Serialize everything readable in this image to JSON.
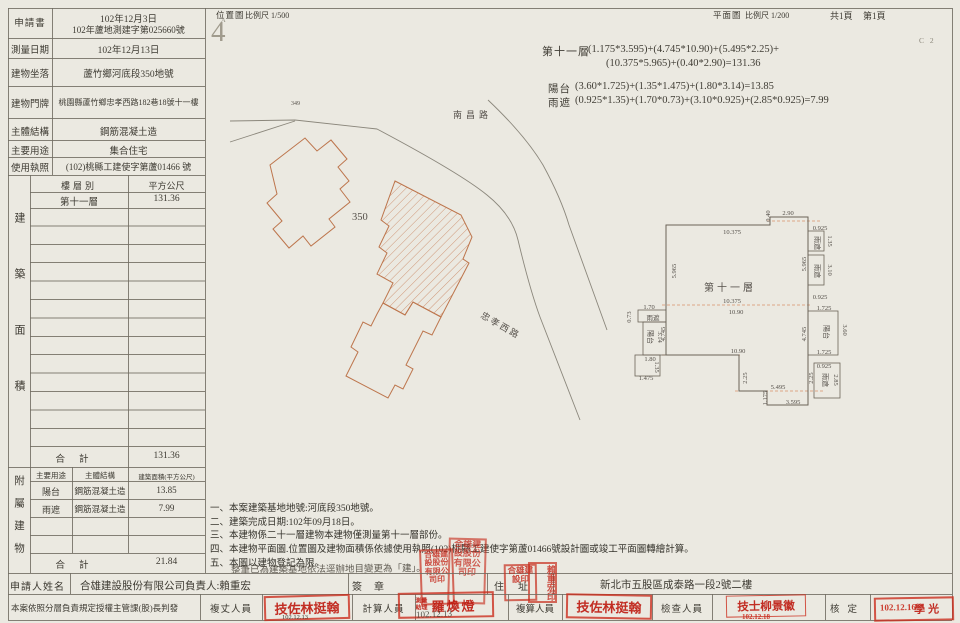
{
  "header": {
    "site_plan": "位置圖",
    "site_scale": "比例尺 1/500",
    "floor_plan": "平面圖",
    "floor_scale": "比例尺 1/200",
    "total_pages": "共1頁",
    "page": "第1頁",
    "code": "C 2",
    "north_mark": "4",
    "north_sub": "A"
  },
  "info": {
    "rows": [
      {
        "label": "申請書",
        "value": "102年12月3日",
        "value2": "102年蘆地測建字第025660號"
      },
      {
        "label": "測量日期",
        "value": "102年12月13日"
      },
      {
        "label": "建物坐落",
        "value": "蘆竹鄉河底段350地號"
      },
      {
        "label": "建物門牌",
        "value": "桃園縣蘆竹鄉忠孝西路182巷18號十一樓"
      },
      {
        "label": "主體結構",
        "value": "鋼筋混凝土造"
      },
      {
        "label": "主要用途",
        "value": "集合住宅"
      },
      {
        "label": "使用執照",
        "value": "(102)桃縣工建使字第蘆01466 號"
      }
    ]
  },
  "area_table": {
    "side_label": "建築面積",
    "col_floor": "樓層別",
    "col_area": "平方公尺",
    "rows": [
      {
        "floor": "第十一層",
        "area": "131.36"
      }
    ],
    "total_label": "合計",
    "total": "131.36"
  },
  "annex_table": {
    "side_label": "附屬建物",
    "col_use": "主要用途",
    "col_struct": "主體結構",
    "col_area": "建築面積(平方公尺)",
    "rows": [
      {
        "use": "陽台",
        "struct": "鋼筋混凝土造",
        "area": "13.85"
      },
      {
        "use": "雨遮",
        "struct": "鋼筋混凝土造",
        "area": "7.99"
      }
    ],
    "total_label": "合計",
    "total": "21.84"
  },
  "applicant": {
    "label": "申請人姓名",
    "value": "合雄建設股份有限公司負責人:賴重宏",
    "seal_label": "簽章",
    "addr_label": "住址",
    "address": "新北市五股區成泰路一段2號二樓"
  },
  "approval": {
    "delegation": "本案依照分層負責規定授權主管課(股)長判發",
    "surveyor_label": "複丈人員",
    "surveyor_stamp": "技佐林挺翰",
    "surveyor_date": "102.12.13",
    "calculator_label": "計算人員",
    "calculator_stamp_title": "測量助理",
    "calculator_stamp": "羅煥燈",
    "calculator_date": "102.12.13",
    "checker_label": "複算人員",
    "checker_stamp": "技佐林挺翰",
    "inspector_label": "檢查人員",
    "inspector_stamp": "技士柳景徽",
    "inspector_date": "102.12.18",
    "approver_label": "核定",
    "approver_stamp": "學光",
    "approver_date": "102.12.16"
  },
  "formulas": {
    "floor_label": "第十一層",
    "floor_1": "(1.175*3.595)+(4.745*10.90)+(5.495*2.25)+",
    "floor_2": "(10.375*5.965)+(0.40*2.90)=131.36",
    "balcony_label": "陽台",
    "balcony": "(3.60*1.725)+(1.35*1.475)+(1.80*3.14)=13.85",
    "eave_label": "雨遮",
    "eave": "(0.925*1.35)+(1.70*0.73)+(3.10*0.925)+(2.85*0.925)=7.99"
  },
  "notes": {
    "items": [
      "一、本案建築基地地號:河底段350地號。",
      "二、建築完成日期:102年09月18日。",
      "三、本建物係二十一層建物本建物僅測量第十一層部份。",
      "四、本建物平面圖.位置圖及建物面積係依據使用執照(102)桃縣工建使字第蘆01466號設計圖或竣工平面圖轉繪計算。",
      "五、本圖以建物登記為限。"
    ],
    "stamp_line": "整筆已為建築基地依法逕辦地目變更為「建」。"
  },
  "site_plan": {
    "road_top": "南昌路",
    "road_bottom": "忠孝西路",
    "lot": "350",
    "lot_adjacent": "349"
  },
  "floor_plan": {
    "title": "第十一層",
    "dims": [
      {
        "t": "0.40"
      },
      {
        "t": "2.90"
      },
      {
        "t": "10.375"
      },
      {
        "t": "5.965"
      },
      {
        "t": "10.375"
      },
      {
        "t": "10.90"
      },
      {
        "t": "10.90"
      },
      {
        "t": "0.925"
      },
      {
        "t": "雨遮"
      },
      {
        "t": "1.35"
      },
      {
        "t": "5.965"
      },
      {
        "t": "雨遮"
      },
      {
        "t": "3.10"
      },
      {
        "t": "0.925"
      },
      {
        "t": "1.725"
      },
      {
        "t": "陽台"
      },
      {
        "t": "3.60"
      },
      {
        "t": "4.745"
      },
      {
        "t": "1.725"
      },
      {
        "t": "0.925"
      },
      {
        "t": "雨遮"
      },
      {
        "t": "2.85"
      },
      {
        "t": "2.25"
      },
      {
        "t": "2.25"
      },
      {
        "t": "5.495"
      },
      {
        "t": "1.175"
      },
      {
        "t": "3.595"
      },
      {
        "t": "0.73"
      },
      {
        "t": "1.70"
      },
      {
        "t": "雨遮"
      },
      {
        "t": "陽台"
      },
      {
        "t": "3.14"
      },
      {
        "t": "4.745"
      },
      {
        "t": "1.80"
      },
      {
        "t": "1.35"
      },
      {
        "t": "1.475"
      }
    ]
  },
  "seals": {
    "company_seal": "合雄建設股份有限公司印",
    "office_seal": "合雄建設股份有限公司印",
    "signer_seal_1": "合雄建設印",
    "signer_seal_2": "賴重宏印"
  }
}
